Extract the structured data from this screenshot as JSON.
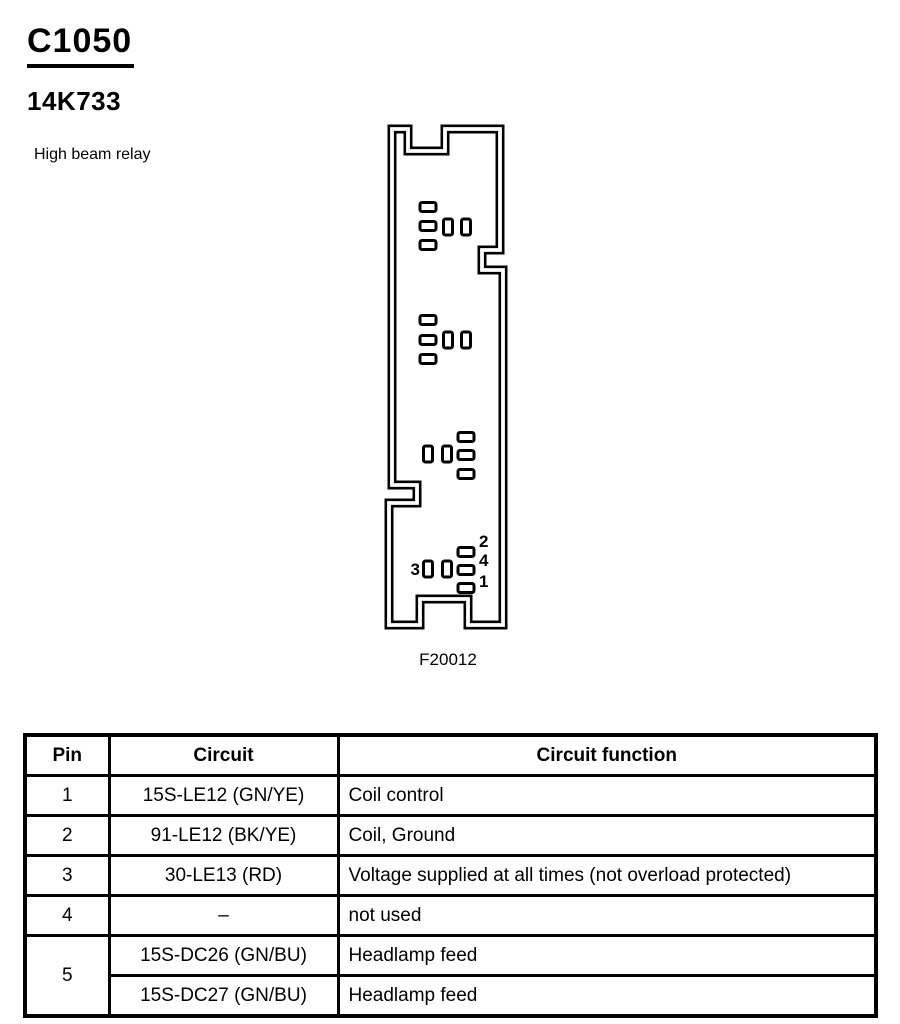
{
  "header": {
    "connector_id": "C1050",
    "part_number": "14K733",
    "description": "High beam relay"
  },
  "diagram": {
    "figure_label": "F20012",
    "pin_labels": {
      "left": "3",
      "right_top": "2",
      "right_middle": "4",
      "right_bottom": "1"
    }
  },
  "table": {
    "headers": {
      "pin": "Pin",
      "circuit": "Circuit",
      "function": "Circuit function"
    },
    "rows": [
      {
        "pin": "1",
        "circuit": "15S-LE12 (GN/YE)",
        "function": "Coil control"
      },
      {
        "pin": "2",
        "circuit": "91-LE12 (BK/YE)",
        "function": "Coil, Ground"
      },
      {
        "pin": "3",
        "circuit": "30-LE13 (RD)",
        "function": "Voltage supplied at all times (not overload protected)"
      },
      {
        "pin": "4",
        "circuit": "–",
        "function": "not used"
      },
      {
        "pin": "5",
        "circuit": "15S-DC26 (GN/BU)",
        "function": "Headlamp feed"
      },
      {
        "pin": "",
        "circuit": "15S-DC27 (GN/BU)",
        "function": "Headlamp feed"
      }
    ]
  }
}
